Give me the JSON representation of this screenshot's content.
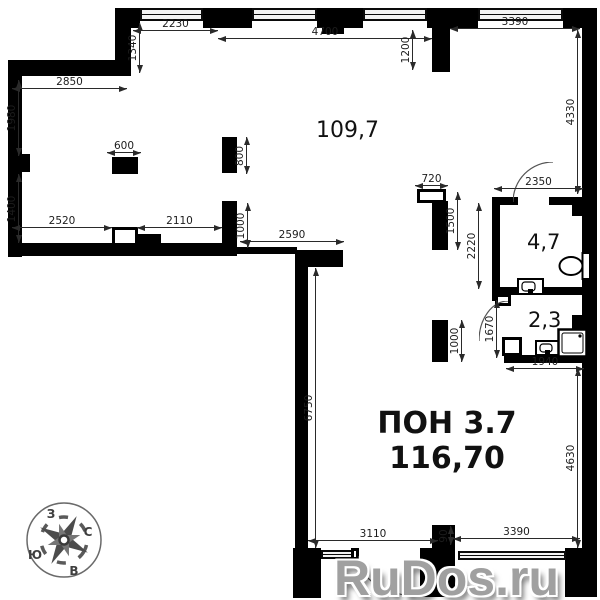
{
  "watermark": {
    "text": "RuDos.ru"
  },
  "compass": {
    "west": "З",
    "north": "С",
    "south": "Ю",
    "east": "В"
  },
  "rooms": {
    "hall_area": "109,7",
    "wc_area": "4,7",
    "shower_area": "2,3",
    "main_name": "ПОН 3.7",
    "main_area": "116,70"
  },
  "dims": {
    "top_2230": "2230",
    "top_4700": "4700",
    "top_3390": "3390",
    "left_1340": "1340",
    "stub_1200": "1200",
    "right_4330": "4330",
    "left_2850": "2850",
    "left_1980": "1980",
    "col_600": "600",
    "pil_800": "800",
    "left_1400": "1400",
    "bot_2520": "2520",
    "bot_2110": "2110",
    "pil_1000_upper": "1000",
    "mid_2590": "2590",
    "shaft_720": "720",
    "shaft_1500": "1500",
    "wc_2350": "2350",
    "wc_2220": "2220",
    "shower_1670": "1670",
    "pil_1000_lower": "1000",
    "shower_1940": "1940",
    "low_6750": "6750",
    "low_4630": "4630",
    "bottom_3110": "3110",
    "bottom_90": "90",
    "bottom_3390": "3390"
  },
  "colors": {
    "wall": "#000000",
    "bg": "#ffffff",
    "dim_line": "#2a2a2a",
    "watermark": "#a0a0a0"
  }
}
